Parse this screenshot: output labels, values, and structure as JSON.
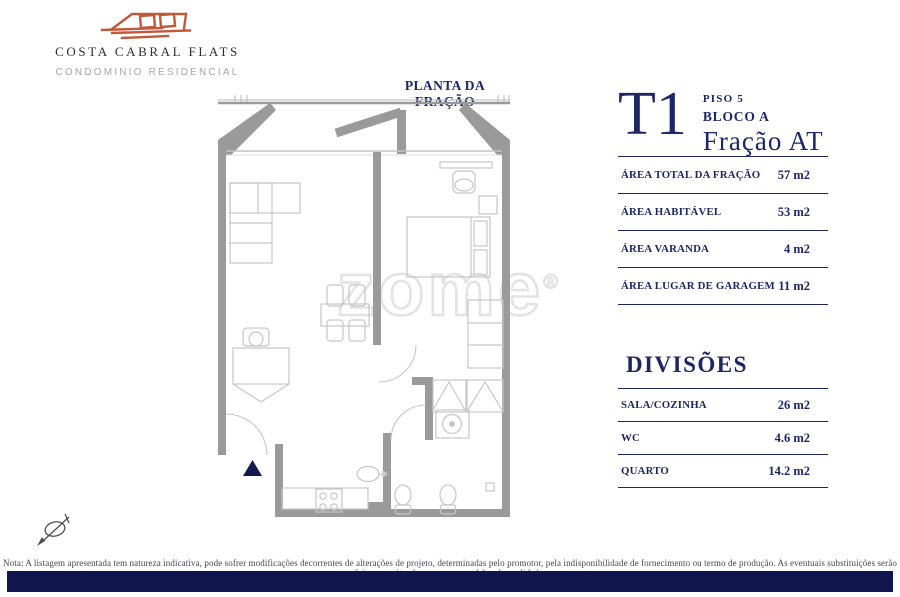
{
  "brand": {
    "name": "COSTA CABRAL FLATS",
    "subtitle": "CONDOMINIO RESIDENCIAL"
  },
  "plan": {
    "title": "PLANTA DA FRAÇÃO",
    "watermark": "zome",
    "watermark_reg": "®"
  },
  "unit": {
    "type": "T1",
    "floor": "PISO 5",
    "block": "BLOCO A",
    "fraction": "Fração AT"
  },
  "areas": {
    "rows": [
      {
        "label": "ÁREA TOTAL DA FRAÇÃO",
        "value": "57 m2"
      },
      {
        "label": "ÁREA HABITÁVEL",
        "value": "53 m2"
      },
      {
        "label": "ÁREA VARANDA",
        "value": "4 m2"
      },
      {
        "label": "ÁREA LUGAR DE GARAGEM",
        "value": "11 m2"
      }
    ]
  },
  "divisions": {
    "title": "DIVISÕES",
    "rows": [
      {
        "label": "SALA/COZINHA",
        "value": "26 m2"
      },
      {
        "label": "WC",
        "value": "4.6 m2"
      },
      {
        "label": "QUARTO",
        "value": "14.2 m2"
      }
    ]
  },
  "footer": {
    "note": "Nota: A listagem apresentada tem natureza indicativa, pode sofrer modificações decorrentes de alterações de projeto, determinadas pelo promotor, pela indisponibilidade de fornecimento ou termo de produção. As eventuais substituições serão feitas respeitando os mesmos padrões de qualidade."
  },
  "icons": {
    "logo": "brand-logo-icon",
    "compass": "compass-icon"
  },
  "colors": {
    "navy": "#1d2766",
    "bar_navy": "#10154e",
    "logo_orange": "#c2583a",
    "wall_gray": "#9a9a9a",
    "furniture_gray": "#c6c6c6",
    "watermark_gray": "#e3e3e3"
  }
}
